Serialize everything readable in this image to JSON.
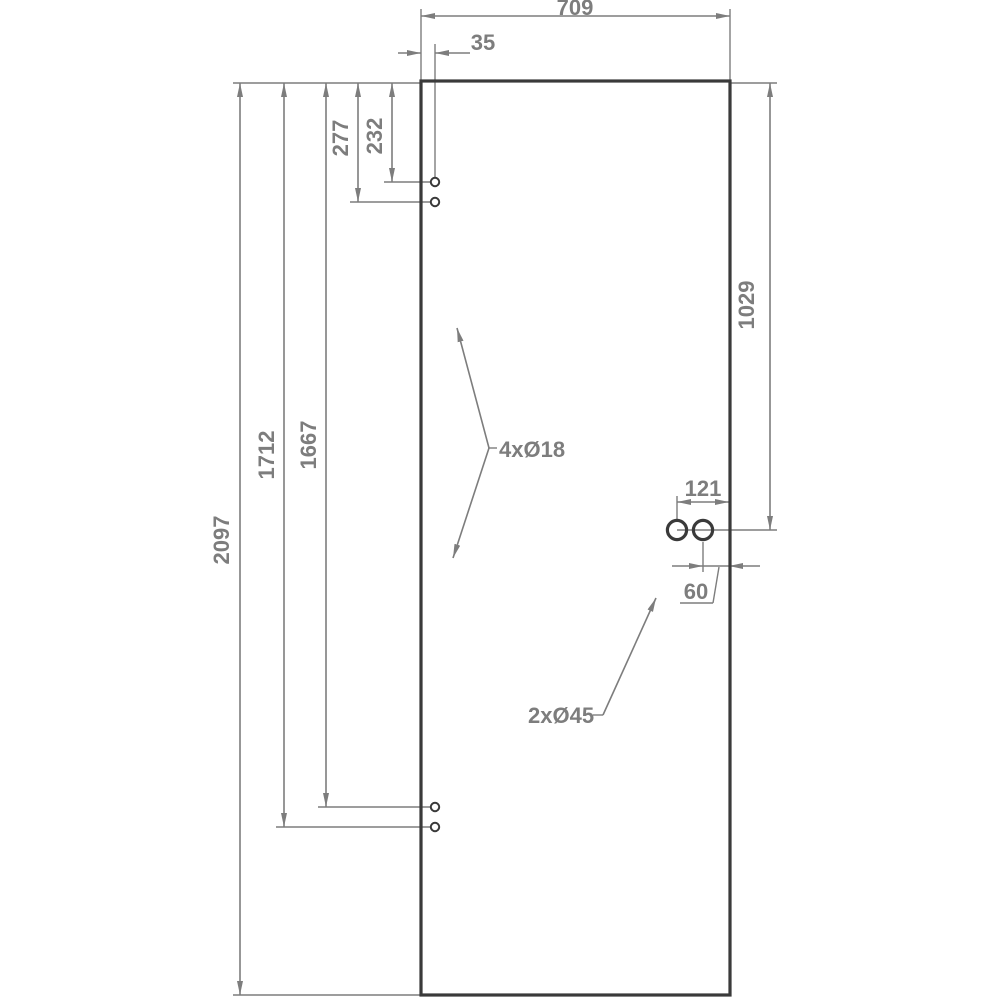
{
  "drawing": {
    "dimensions": {
      "overall_width": "709",
      "hole_offset_from_edge": "35",
      "top_hole1_from_top": "232",
      "top_hole2_from_top": "277",
      "bottom_hole1_from_top": "1667",
      "bottom_hole2_from_top": "1712",
      "overall_height": "2097",
      "handle_from_top": "1029",
      "handle_left_hole_from_edge": "121",
      "handle_right_hole_from_edge": "60"
    },
    "labels": {
      "small_holes": "4xØ18",
      "large_holes": "2xØ45"
    },
    "colors": {
      "bg": "#ffffff",
      "outline": "#3a3a3a",
      "dimension": "#7d7d7d"
    }
  }
}
